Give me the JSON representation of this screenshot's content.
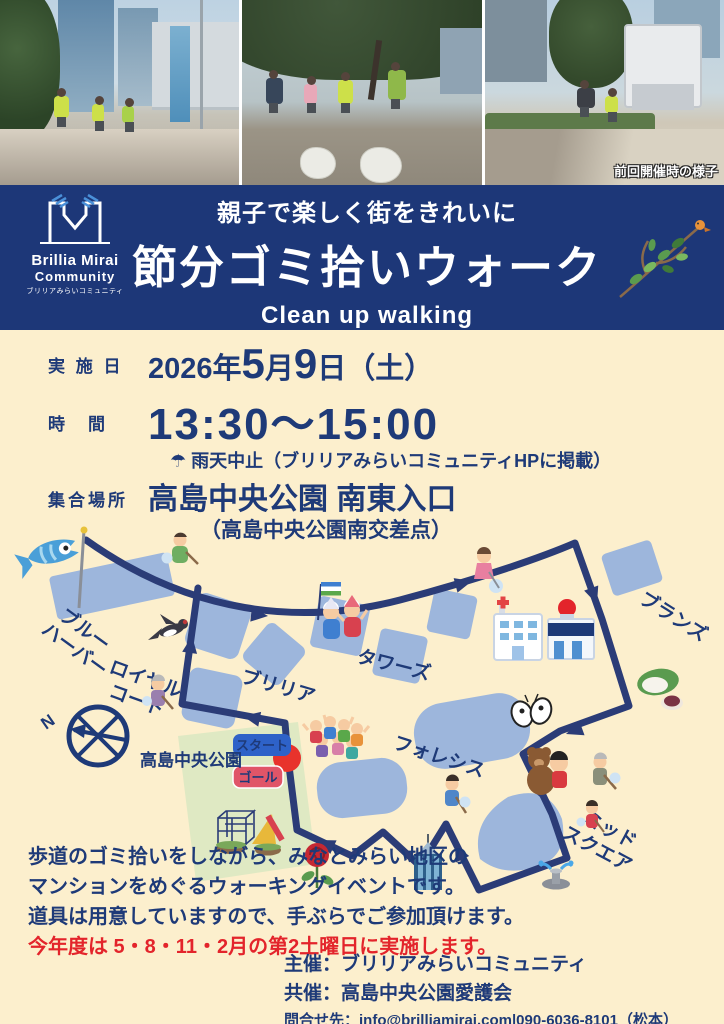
{
  "colors": {
    "navy": "#1d3778",
    "cream": "#fcefcd",
    "blob_blue": "#9db6dc",
    "route_navy": "#2b3c77",
    "accent_red": "#e3242b",
    "start_badge_blue": "#2e62c8",
    "goal_badge_red": "#e05568",
    "park_green": "#dfe9c3",
    "vest_green": "#cde049"
  },
  "photos": {
    "caption": "前回開催時の様子"
  },
  "header": {
    "subtitle": "親子で楽しく街をきれいに",
    "title": "節分ゴミ拾いウォーク",
    "subtitle_en": "Clean up walking",
    "logo": {
      "name1": "Brillia Mirai",
      "name2": "Community",
      "name3": "ブリリアみらいコミュニティ"
    }
  },
  "details": {
    "date_label": "実 施 日",
    "date": {
      "year": "2026年",
      "month_num": "5",
      "month": "月",
      "day_num": "9",
      "day": "日",
      "week": "（土）"
    },
    "time_label": "時　間",
    "time_value": "13:30〜15:00",
    "rain_icon": "☂",
    "rain_note": "雨天中止（ブリリアみらいコミュニティHPに掲載）",
    "place_label": "集合場所",
    "place_value": "高島中央公園 南東入口",
    "place_sub": "（高島中央公園南交差点）"
  },
  "map": {
    "label_blue_harbor_1": "ブルー",
    "label_blue_harbor_2": "ハーバー",
    "label_royal_court_1": "ロイヤル",
    "label_royal_court_2": "コート",
    "label_brillia": "ブリリア",
    "label_towers": "タワーズ",
    "label_branz": "ブランズ",
    "label_foresis": "フォレシス",
    "label_midsquare_1": "ミッド",
    "label_midsquare_2": "スクエア",
    "label_park": "高島中央公園",
    "badge_start": "スタート",
    "badge_goal": "ゴール",
    "police_sign": "POLICE",
    "compass_n": "N"
  },
  "description": {
    "lines": [
      "歩道のゴミ拾いをしながら、みなとみらい地区の",
      "マンションをめぐるウォーキングイベントです。",
      "道具は用意していますので、手ぶらでご参加頂けます。",
      "今年度は 5・8・11・2月の第2土曜日に実施します。"
    ]
  },
  "footer": {
    "host": "主催：ブリリアみらいコミュニティ",
    "cohost": "共催：高島中央公園愛護会",
    "contact": "問合せ先：info@brilliamirai.com|090-6036-8101（松本）"
  }
}
